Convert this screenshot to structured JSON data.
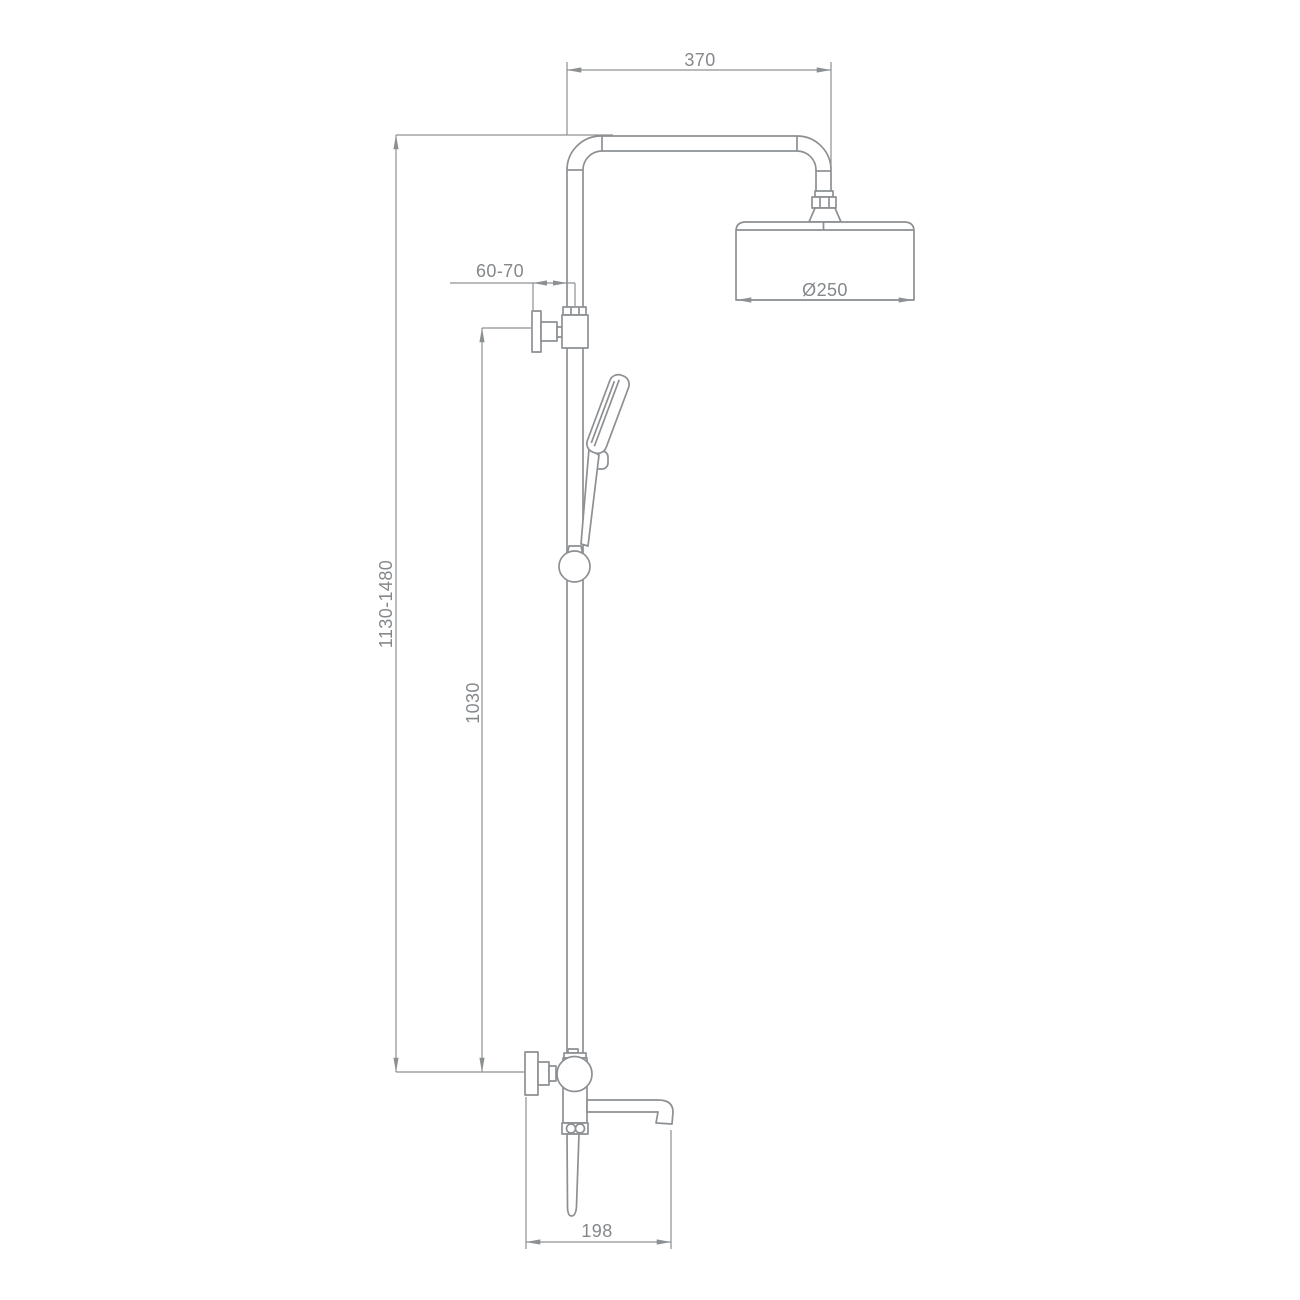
{
  "page": {
    "background": "#ffffff",
    "description": "Technical dimension drawing (side elevation) of a shower column with overhead rain shower, hand shower on sliding rail and bath mixer with spout"
  },
  "drawing": {
    "line_color": "#8d9093",
    "text_color": "#85888b",
    "labels": {
      "arm_width": "370",
      "head_diameter": "Ø250",
      "wall_distance": "60-70",
      "overall_height": "1130-1480",
      "riser_height": "1030",
      "spout_reach": "198"
    }
  }
}
